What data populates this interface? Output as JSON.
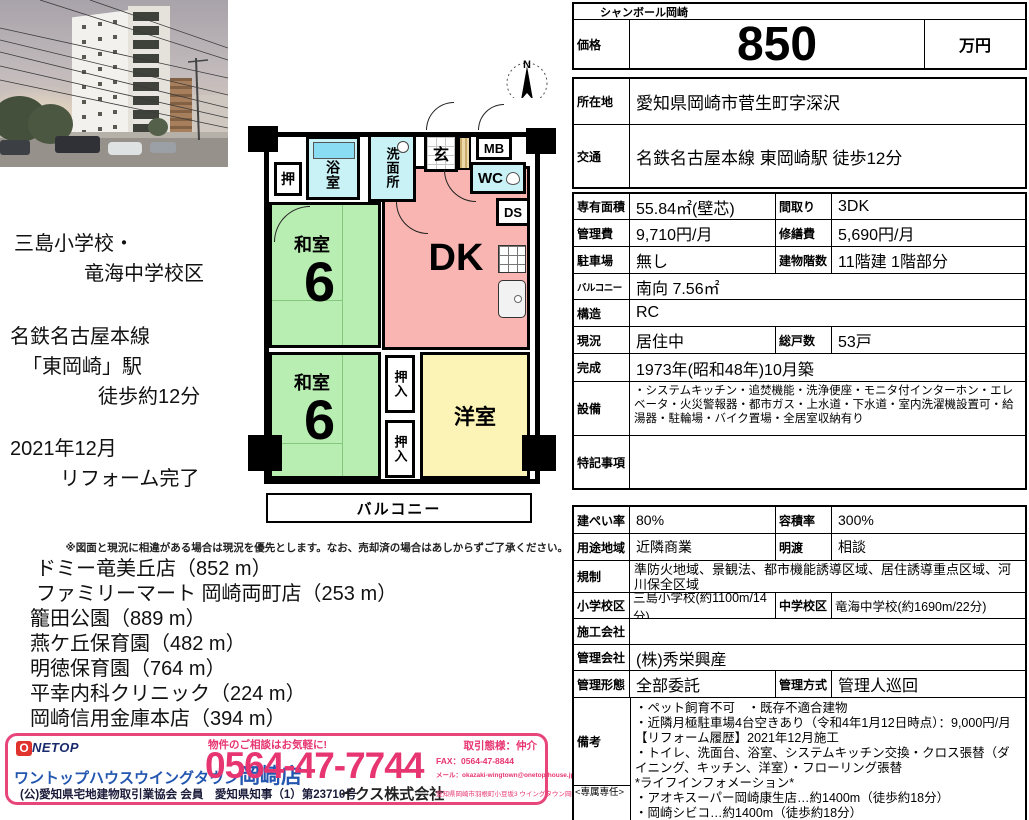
{
  "compass": {
    "north": "N"
  },
  "floorplan": {
    "closet": "押",
    "bath": "浴室",
    "washroom": "洗面所",
    "entrance": "玄",
    "meter_box": "MB",
    "toilet": "WC",
    "duct": "DS",
    "dining_kitchen": "DK",
    "japanese_room": "和室",
    "japanese_room_size": "6",
    "closet_futon": "押入",
    "western_room": "洋室",
    "balcony": "バルコニー"
  },
  "left_notes": {
    "school_line1": "三島小学校・",
    "school_line2": "竜海中学校区",
    "station_line1": "名鉄名古屋本線",
    "station_line2": "「東岡崎」駅",
    "station_line3": "徒歩約12分",
    "reform_line1": "2021年12月",
    "reform_line2": "リフォーム完了"
  },
  "disclaimer": "※図面と現況に相違がある場合は現況を優先とします。なお、売却済の場合はあしからずご了承ください。",
  "facilities": [
    "ドミー竜美丘店（852 m）",
    "ファミリーマート 岡崎両町店（253 m）",
    "籠田公園（889 m）",
    "燕ケ丘保育園（482 m）",
    "明徳保育園（764 m）",
    "平幸内科クリニック（224 m）",
    "岡崎信用金庫本店（394 m）"
  ],
  "footer": {
    "logo_first": "O",
    "logo_rest": "NETOP",
    "shop_name": "ワントップハウスウイングタウン",
    "shop_branch": "岡崎店",
    "consult": "物件のご相談はお気軽に!",
    "phone": "0564-47-7744",
    "deal_type": "取引態様：仲介",
    "fax": "FAX：0564-47-8844",
    "mail": "メール：okazaki-wingtown@onetop-house.jp",
    "license": "(公)愛知県宅地建物取引業協会 会員　愛知県知事（1）第23710号",
    "company": "イクス株式会社",
    "address": "愛知県岡崎市羽根町小豆坂3 ウイングタウン岡崎1F"
  },
  "listing": {
    "building_name": "シャンボール岡崎",
    "price_label": "価格",
    "price": "850",
    "price_unit": "万円",
    "location_label": "所在地",
    "location": "愛知県岡崎市菅生町字深沢",
    "access_label": "交通",
    "access": "名鉄名古屋本線 東岡崎駅 徒歩12分",
    "area_label": "専有面積",
    "area": "55.84㎡(壁芯)",
    "layout_label": "間取り",
    "layout": "3DK",
    "mgmt_fee_label": "管理費",
    "mgmt_fee": "9,710円/月",
    "repair_fee_label": "修繕費",
    "repair_fee": "5,690円/月",
    "parking_label": "駐車場",
    "parking": "無し",
    "floors_label": "建物階数",
    "floors": "11階建 1階部分",
    "balcony_label": "バルコニー",
    "balcony": "南向 7.56㎡",
    "structure_label": "構造",
    "structure": "RC",
    "status_label": "現況",
    "status": "居住中",
    "units_label": "総戸数",
    "units": "53戸",
    "built_label": "完成",
    "built": "1973年(昭和48年)10月築",
    "equipment_label": "設備",
    "equipment": "・システムキッチン・追焚機能・洗浄便座・モニタ付インターホン・エレベータ・火災警報器・都市ガス・上水道・下水道・室内洗濯機設置可・給湯器・駐輪場・バイク置場・全居室収納有り",
    "notes_label": "特記事項",
    "notes": "",
    "coverage_label": "建ぺい率",
    "coverage": "80%",
    "far_label": "容積率",
    "far": "300%",
    "zoning_label": "用途地域",
    "zoning": "近隣商業",
    "handover_label": "明渡",
    "handover": "相談",
    "regulation_label": "規制",
    "regulation": "準防火地域、景観法、都市機能誘導区域、居住誘導重点区域、河川保全区域",
    "elementary_label": "小学校区",
    "elementary": "三島小学校(約1100m/14分)",
    "junior_label": "中学校区",
    "junior": "竜海中学校(約1690m/22分)",
    "builder_label": "施工会社",
    "builder": "",
    "mgmt_co_label": "管理会社",
    "mgmt_co": "(株)秀栄興産",
    "mgmt_form_label": "管理形態",
    "mgmt_form": "全部委託",
    "mgmt_method_label": "管理方式",
    "mgmt_method": "管理人巡回",
    "remarks_label": "備考",
    "remarks": "・ペット飼育不可　・既存不適合建物\n・近隣月極駐車場4台空きあり（令和4年1月12日時点）：9,000円/月\n【リフォーム履歴】2021年12月施工\n・トイレ、洗面台、浴室、システムキッチン交換・クロス張替（ダイニング、キッチン、洋室）・フローリング張替\n*ライフインフォメーション*\n・アオキスーパー岡崎康生店…約1400m（徒歩約18分）\n・岡崎シビコ…約1400m（徒歩約18分）\n・ファミリーマート岡崎両町店…約450m（徒歩約6分）",
    "exclusive": "<専属専任>"
  },
  "colors": {
    "tatami": "#b9eeb2",
    "dk_pink": "#f9b5b2",
    "western_yellow": "#fcf4b6",
    "wet_cyan": "#c9f2f6",
    "tub_blue": "#8adcf2",
    "accent_pink": "#e8457a",
    "phone_red": "#e73571",
    "shop_blue": "#2356af",
    "wall_black": "#000000"
  }
}
